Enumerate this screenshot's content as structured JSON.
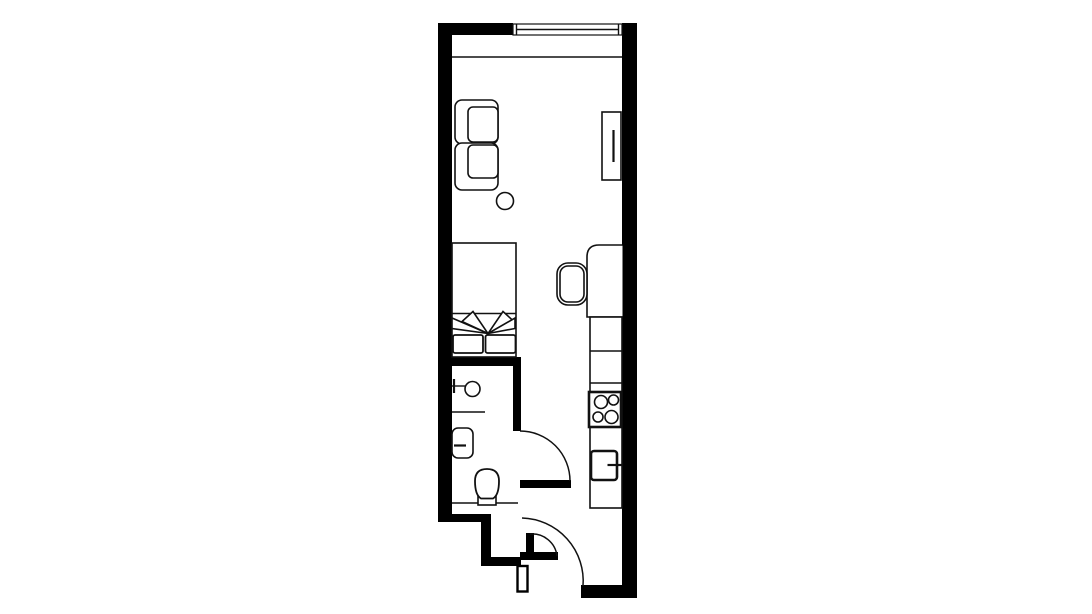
{
  "page": {
    "title": "Studio apartment floor plan"
  },
  "style": {
    "background": "#ffffff",
    "wall_color": "#000000",
    "line_color": "#111111"
  },
  "plan": {
    "type": "floor-plan",
    "rooms": [
      {
        "name": "living-sleeping-area"
      },
      {
        "name": "bathroom"
      },
      {
        "name": "kitchen-strip"
      },
      {
        "name": "entry-hall"
      }
    ],
    "openings": [
      {
        "name": "window",
        "location": "top wall"
      },
      {
        "name": "bathroom-door",
        "swing": "quarter-arc"
      },
      {
        "name": "entry-door",
        "swing": "quarter-arc"
      }
    ],
    "furniture": [
      "sofa",
      "side-table",
      "tv-sideboard",
      "bed",
      "pillow-left",
      "pillow-right",
      "desk",
      "desk-chair",
      "kitchen-counter",
      "stove",
      "kitchen-sink",
      "shower",
      "washbasin",
      "toilet"
    ]
  }
}
